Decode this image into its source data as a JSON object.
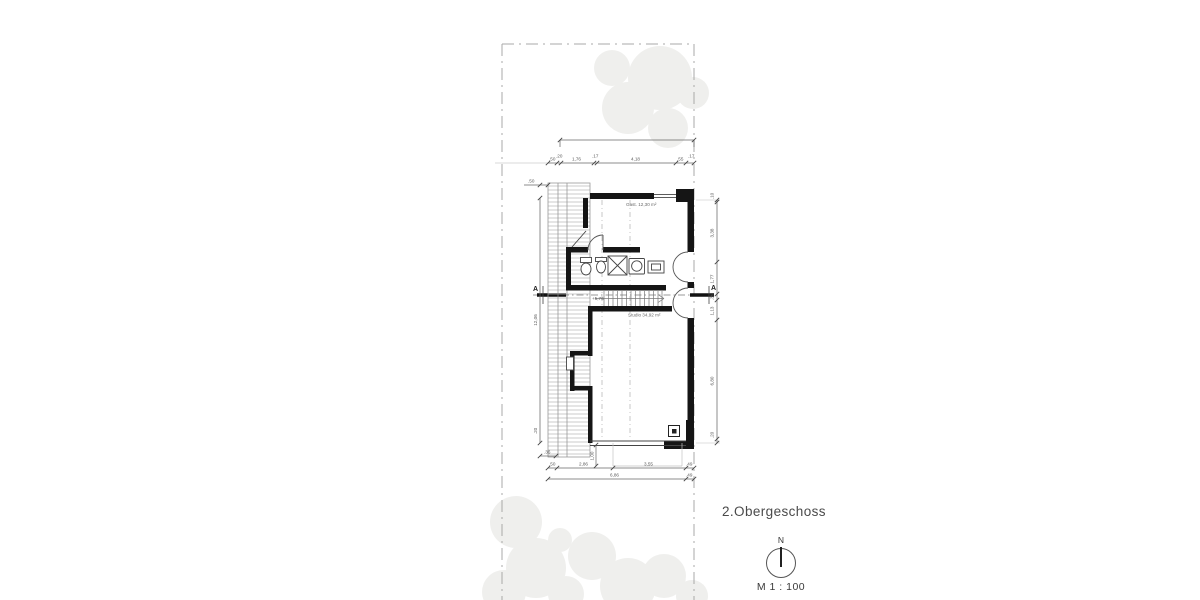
{
  "title": "2.Obergeschoss",
  "scale_label": "M 1 : 100",
  "north_label": "N",
  "labels": {
    "gast": "Gast. 12,30 m²",
    "studio": "Studio 34,92 m²",
    "stair_level": "+5,76",
    "section_left": "A",
    "section_right": "A"
  },
  "dims": {
    "top": [
      ".50",
      ".20",
      "1,76",
      ".17",
      "4,18",
      ".55",
      ".17"
    ],
    "right": [
      ".10",
      "3,38",
      "1,77",
      ".36",
      "1,13",
      "6,80",
      ".20"
    ],
    "left_overall": "12,06",
    "left_top": ".50",
    "left_bottom": [
      ".20",
      ".36"
    ],
    "bottom_row1": [
      ".50",
      "2,86",
      "3,55",
      ".49"
    ],
    "bottom_row2": [
      "6,86",
      ".49"
    ],
    "stair_width": "1,00"
  },
  "colors": {
    "wall": "#151515",
    "dim_line": "#666666",
    "boundary": "#a8a8a8",
    "hatch": "#b5b5b5",
    "tree": "#efefed"
  }
}
